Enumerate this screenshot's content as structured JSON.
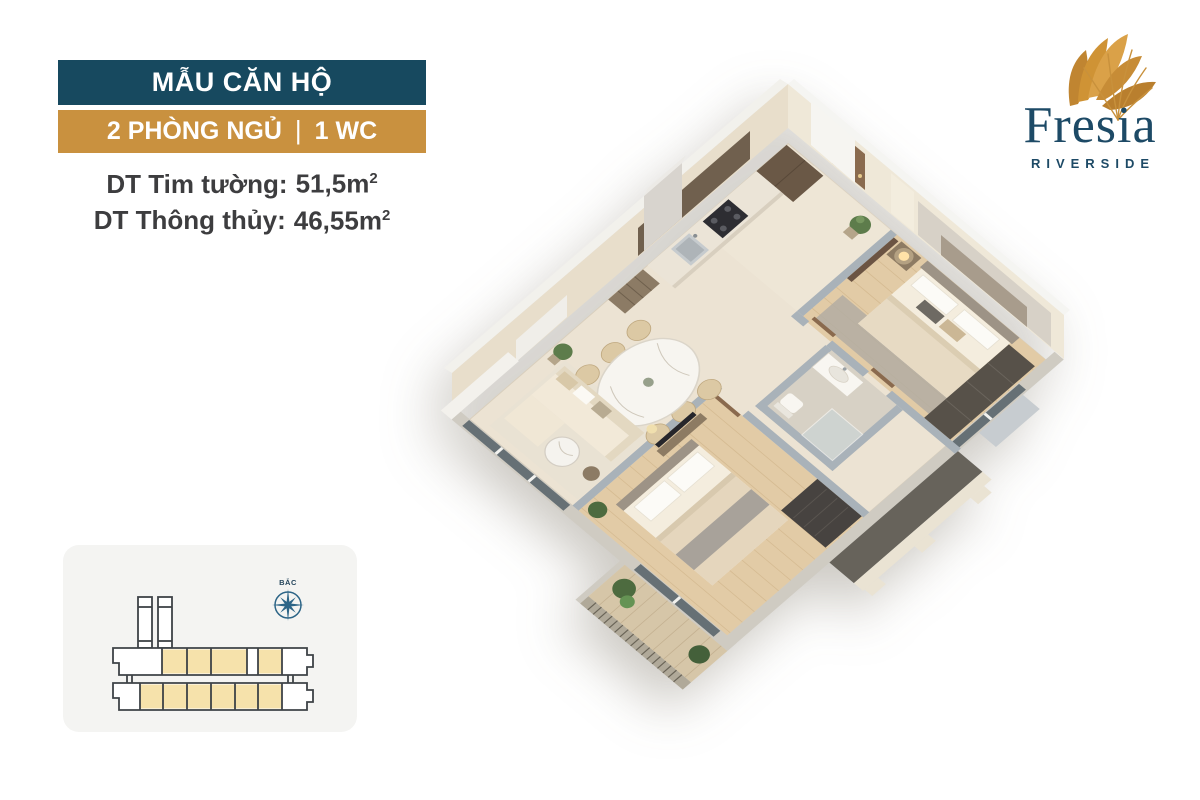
{
  "page": {
    "background": "#ffffff"
  },
  "header": {
    "title": "MẪU CĂN HỘ",
    "title_bg": "#17495f",
    "subtitle": {
      "left": "2 PHÒNG NGỦ",
      "sep": "|",
      "right": "1 WC"
    },
    "subtitle_bg": "#c9913f",
    "specs": [
      {
        "label": "DT Tim tường:",
        "value": "51,5m",
        "sup": "2"
      },
      {
        "label": "DT Thông thủy:",
        "value": "46,55m",
        "sup": "2"
      }
    ]
  },
  "logo": {
    "wordmark": "Fresia",
    "tagline": "RIVERSIDE",
    "text_color": "#1d4a66",
    "flower_color": "#c9903f"
  },
  "siteplan": {
    "compass_label": "BẮC",
    "unit_highlight_color": "#f6e2ab",
    "outline_color": "#3e4347",
    "compass_color": "#2d6587"
  },
  "floorplan": {
    "rooms": [
      "entry",
      "kitchen",
      "dining",
      "living-room",
      "bathroom",
      "master-bedroom",
      "bedroom-2",
      "balcony"
    ],
    "wall_color": "#efe8d8",
    "wood_floor_color": "#e2cba6",
    "tile_floor_color": "#ece3d3"
  }
}
